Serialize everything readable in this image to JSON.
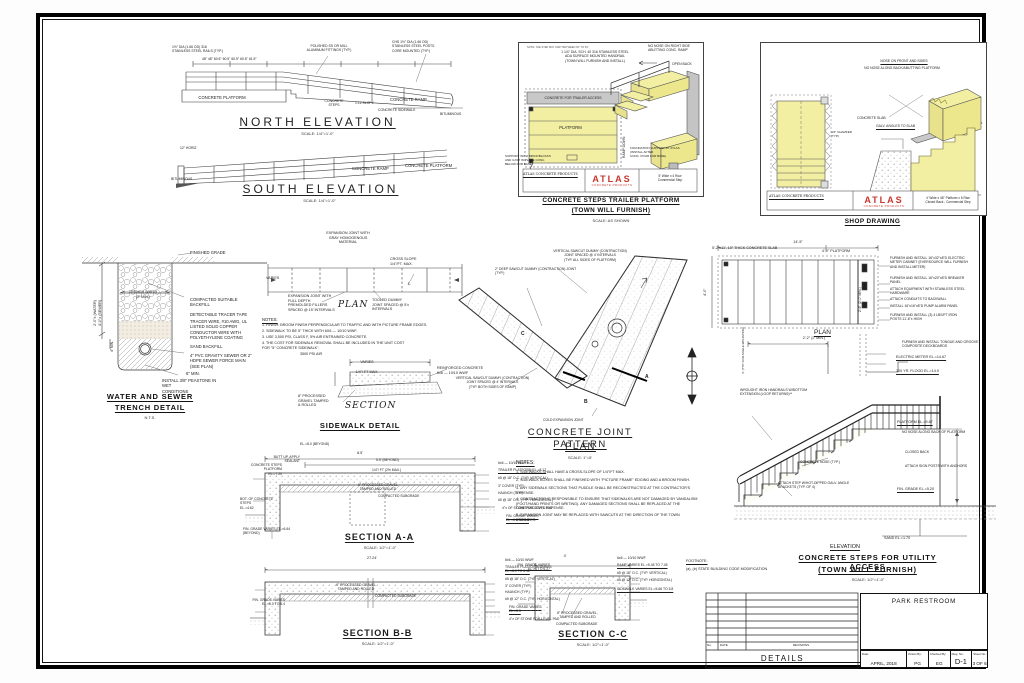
{
  "sheet": {
    "project": "PARK RESTROOM",
    "sheet_title": "DETAILS",
    "revisions_label": "REVISIONS",
    "no_label": "No.",
    "date_col_label": "DATE",
    "date_label": "Date:",
    "date": "APRIL, 2018",
    "drawn_label": "Drawn By:",
    "drawn": "PG",
    "checked_label": "Checked By:",
    "checked": "EG",
    "dwg_label": "Dwg. No.:",
    "dwg_no": "D-1",
    "sheet_no_label": "Sheet No.:",
    "sheet_no": "3 OF 6"
  },
  "north_elevation": {
    "title": "NORTH ELEVATION",
    "scale": "SCALE: 1/4\"=1'-0\"",
    "rail_note": "1½\" DIA (1.66 OD) 316\nSTAINLESS STEEL RAILS (TYP.)",
    "fittings_note": "POLISHED SS OR MILL\nALUMINUM FITTINGS (TYP.)",
    "posts_note": "CHS 1½\" DIA (1.66 OD)\nSTAINLESS STEEL POSTS\nCORE MOUNTED (TYP.)",
    "dims": "48\"        48\"        60.5\"        60.5\"        60.5\"        60.5\"        61.5\"",
    "platform": "CONCRETE PLATFORM",
    "steps": "CONCRETE\nSTEPS",
    "slope": "1:12 SLOPE",
    "ramp": "CONCRETE RAMP",
    "sidewalk": "CONCRETE SIDEWALK",
    "bituminous": "BITUMINOUS"
  },
  "south_elevation": {
    "title": "SOUTH ELEVATION",
    "scale": "SCALE: 1/4\"=1'-0\"",
    "horiz": "12\" HORIZ",
    "bituminous": "BITUMINOUS",
    "ramp": "CONCRETE RAMP",
    "platform": "CONCRETE PLATFORM"
  },
  "trailer_platform": {
    "small_note": "NOTE: THE STEP MAY VARY BETWEEN 52\" TO 54\"",
    "handrail_note": "1 1/4\" DIA. SCH. 40 316 STAINLESS STEEL\nADA SURFACE MOUNTED HANDRAIL\n(TOWN WILL FURNISH AND INSTALL)",
    "no_nose": "NO NOSE ON RIGHT SIDE\nABUTTING CONC. RAMP",
    "open_back": "OPEN BACK",
    "header": "CONCRETE FOR TRAILER ACCESS",
    "platform_label": "PLATFORM",
    "ramp_down": "RAMP DOWN",
    "support_note": "SUPPORT WITH BRICK/BLOCKS\nAND CAST IN PLACE CONC.\nBELOW FOR BASE",
    "foundation_note": "FOUNDATION SUPPORT BY ATLAS\n(INSTALL AFTER\nCONC. POUR FOR BASE)",
    "atlas_co": "ATLAS CONCRETE PRODUCTS",
    "atlas_logo": "ATLAS",
    "atlas_sub": "CONCRETE PRODUCTS",
    "product": "5' Wide x 4 Row\nCommercial Step",
    "title1": "CONCRETE STEPS TRAILER PLATFORM",
    "title2": "(TOWN WILL FURNISH)",
    "scale": "SCALE: AS SHOWN"
  },
  "shop_drawing": {
    "nose_note": "NOSE ON FRONT AND SIDES",
    "no_nose_note": "NO NOSE ALONG BACK/ABUTTING PLATFORM",
    "slab": "CONCRETE SLAB",
    "angles": "GALV. ANGLES TO SLAB",
    "chamfer": "3/4\" CHAMFER\n(TYP.)",
    "atlas_co": "ATLAS CONCRETE PRODUCTS",
    "atlas_logo": "ATLAS",
    "atlas_sub": "CONCRETE PRODUCTS",
    "product": "4' Wide x 48\" Platform x 6 Rise\nClosed Back - Commercial Step",
    "title": "SHOP DRAWING"
  },
  "trench_detail": {
    "finished_grade": "FINISHED GRADE",
    "trench_width": "TRENCH WIDTH\n(2' MIN.)",
    "backfill": "COMPACTED SUITABLE\nBACKFILL",
    "tracer_tape": "DETECTABLE TRACER TAPE",
    "tracer_wire": "TRACER WIRE, #10 AWG, UL\nLISTED SOLID COPPER\nCONDUCTOR WIRE WITH\nPOLYETHYLENE COATING",
    "sand": "SAND BACKFILL",
    "pipe": "4\" PVC GRAVITY SEWER OR 2\"\nHDPE SEWER FORCE MAIN\n(SEE PLAN)",
    "min6": "6\" MIN.",
    "peastone": "INSTALL 3/8\" PEASTONE IN WET\nCONDITIONS",
    "depth_dim": "2'-0\"± (WATER)\n4'-0\"± (SEWER)",
    "min4": "4\" MIN.",
    "title1": "WATER AND SEWER",
    "title2": "TRENCH DETAIL",
    "scale": "N.T.S."
  },
  "sidewalk_detail": {
    "plan_label": "PLAN",
    "varies": "VARIES",
    "exp_joint_top": "EXPANSION JOINT WITH\nGRAY HOMOGENOUS\nMATERIAL",
    "cross_slope": "CROSS SLOPE\n1/4\"/FT. MAX.",
    "exp_joint": "EXPANSION JOINT WITH\nFULL DEPTH\nPREMOLDED FILLERS\nSPACED @ 15' INTERVALS",
    "tooled": "TOOLED DUMMY\nJOINT SPACED @ 5'±\nINTERVALS",
    "notes_title": "NOTES:",
    "note1": "1. FINISH: BROOM FINISH PERPENDICULAR TO TRAFFIC AND WITH PICTURE FRAME EDGES.",
    "note2": "2. SIDEWALK TO BE 5\" THICK WITH 6X6 — 10/10 WWF.",
    "note3": "3. USE 3,500 PSI, CLASS F, 5% AIR ENTRAINED CONCRETE.",
    "note4": "4. THE COST FOR SIDEWALK REMOVAL SHALL BE INCLUDED IN THE UNIT COST\n    FOR \"5\" CONCRETE SIDEWALK\".",
    "psi": "3500 PSI AIR",
    "varies2": "VARIES",
    "slope2": "1/4\"/ FT MAX.",
    "reinf": "REINFORCED CONCRETE\n6x6 — 10/10 WWF",
    "gravel": "8\" PROCESSED\nGRAVEL TAMPED\n& ROLLED",
    "section_label": "SECTION",
    "title": "SIDEWALK DETAIL"
  },
  "joint_pattern": {
    "note1": "VERTICAL SAWCUT DUMMY (CONTRACTION)\nJOINT SPACED @ 4' INTERVALS\n(TYP. ALL SIDES OF PLATFORM)",
    "note2": "2\" DEEP SAWCUT DUMMY (CONTRACTION) JOINT\n(TYP.)",
    "note3": "VERTICAL SAWCUT DUMMY (CONTRACTION)\nJOINT SPACED @ 4' INTERVALS\n(TYP. BOTH SIDES OF RAMP)",
    "cold_joint": "COLD EXPANSION JOINT",
    "markers": {
      "a": "A",
      "b": "B",
      "c": "C"
    },
    "title1": "CONCRETE JOINT PATTERN",
    "title2": "PLAN",
    "scale": "SCALE: 1\"=5'"
  },
  "utility_plan": {
    "dim_overall": "14'-5\"",
    "slab_note": "5'-2\"x11', 10\" THICK CONCRETE SLAB",
    "platform_dim": "4'-0\" PLATFORM",
    "left_dim": "4'-0\"",
    "mid_dim": "2'-6\" (2'-0\" MIN.)",
    "callout1": "FURNISH AND INSTALL 16\"x32\"x8\"D ELECTRIC\nMETER CABINET (EVERSOURCE WILL FURNISH\nAND INSTALL METER)",
    "callout2": "FURNISH AND INSTALL 16\"x20\"x8\"D BREAKER\nPANEL",
    "callout3": "ATTACH EQUIPMENT WITH STAINLESS STEEL\nHARDWARE",
    "callout4": "ATTACH CONDUITS TO BACKWALL",
    "callout5": "INSTALL 16\"x16\"x8\"D PUMP ALARM PANEL",
    "callout6": "FURNISH AND INSTALL (3) 4 LBS/FT IRON\nPOSTS 11'-6\"± HIGH",
    "plan_label": "PLAN",
    "dim_bottom": "2'-2\" (2' MIN.)",
    "deck_note": "FURNISH AND INSTALL TONGUE AND GROOVE\nCOMPOSITE DECKBOARDS",
    "meter_el": "ELECTRIC METER EL.=14.67",
    "flood_el": "100 YR. FLOOD EL.=14.0",
    "angle_note": "4\" (TYP. FOR ANGLE MOUNTING)"
  },
  "utility_elevation": {
    "handrail": "WROUGHT IRON HANDRAILS W/BOTTOM\nEXTENSION (LOOP RETURNS)**",
    "platform_el": "PLATFORM EL.=9.67",
    "no_nose": "NO NOSE ALONG BACK OF PLATFORM",
    "closed_back": "CLOSED BACK",
    "sign_posts": "ATTACH SIGN POSTS WITH ANCHORS",
    "nose": "CONCRETE NOSE (TYP.)",
    "brackets": "ATTACH STEP W/HOT-DIPPED GALV. ANGLE\nBRACKETS (TYP. OF 4)",
    "fin_grade": "FIN. GRADE EL.=5.20",
    "sand_el": "SAND EL.=1.70",
    "elev_label": "ELEVATION",
    "title1": "CONCRETE STEPS FOR UTILITY ACCESS",
    "title2": "(TOWN WILL FURNISH)",
    "scale": "SCALE: 1/2\"=1'-0\""
  },
  "general_notes": {
    "title": "NOTES:",
    "item1": "1. SIDEWALKS SHALL HAVE A CROSS-SLOPE OF 1/4\"/FT MAX.",
    "item2": "2. SIDEWALK BOXES SHALL BE FINISHED WITH \"PICTURE FRAME\" EDGING AND A BROOM FINISH.",
    "item3": "3. ANY SIDEWALK SECTIONS THAT PUDDLE SHALL BE RECONSTRUCTED AT THE CONTRACTOR'S\n    EXPENSE.",
    "item4": "4. CONTRACTOR IS RESPONSIBLE TO ENSURE THAT SIDEWALKS ARE NOT DAMAGED BY VANDALISM\n    (FOOT/HAND PRINTS OR WRITING).  ANY DAMAGED SECTIONS SHALL BE REPLACED AT THE\n    CONTRACTOR'S EXPENSE.",
    "item5": "5. EXPANSION JOINT MAY BE REPLACED WITH SAWCUTS AT THE DIRECTION OF THE TOWN\n    ENGINEER."
  },
  "footnote": {
    "title": "FOOTNOTE:",
    "text": "(a), (b) STATE BUILDING CODE MODIFICATION"
  },
  "section_aa": {
    "el_beyond": "EL.=8.0 (BEYOND)",
    "dim1": "8.5'",
    "dim2": "5.5' (BEYOND)",
    "butt": "BUTT UP, APPLY\nSEALANT",
    "platform": "CONCRETE STEPS\nPLATFORM\nEL.=7.20",
    "slope": "1/4\"/ FT (2% MAX.)",
    "wwf": "6x6 — 10/10 WWF",
    "trailer_el": "TRAILER PLATFORM EL.=8.12",
    "vert": "#5 @ 18\" O.C. (TYP. VERTICAL)",
    "cover": "3\" COVER (TYP.)",
    "haunch": "HAUNCH (TYP.)",
    "horiz": "#5 @ 18\" O.C. (TYP. HORIZONTAL)",
    "stone": "4\"± OF STONE FOR LEVEL PAD",
    "fin_grade_r": "FIN. GRADE VARIES\nEL.=6.4 TO 5.3",
    "bot": "BOT. OF CONCRETE STEPS\nEL.=4.62",
    "gravel": "6\" PROCESSED GRAVEL\nTAMPED AND ROLLED",
    "subgrade": "COMPACTED SUBGRADE",
    "fin_grade_l": "FIN. GRADE VARIES EL.=6.64\n(BEYOND)",
    "title": "SECTION A-A",
    "scale": "SCALE: 1/2\"=1'-0\""
  },
  "section_bb": {
    "dim": "27.24'",
    "wwf": "6x6 — 10/10 WWF",
    "trailer": "TRAILER PLATFORM VARIES\nEL.=8.0 TO 8.12",
    "vert": "#5 @ 18\" O.C. (TYP. VERTICAL)",
    "cover": "3\" COVER (TYP.)",
    "haunch": "HAUNCH (TYP.)",
    "horiz": "#5 @ 12\" O.C. (TYP. HORIZONTAL)",
    "fin_grade_r": "FIN. GRADE VARIES\nEL.=5.5",
    "stone": "4\"± OF STONE FOR LEVEL PAD",
    "gravel": "6\" PROCESSED GRAVEL\nTAMPED AND ROLLED",
    "subgrade": "COMPACTED SUBGRADE",
    "fin_grade_l": "FIN. GRADE VARIES\nEL.=6.0 TO 5.4",
    "title": "SECTION B-B",
    "scale": "SCALE: 1/2\"=1'-0\""
  },
  "section_cc": {
    "dim": "4'",
    "wwf": "6x6 — 10/10 WWF",
    "ramp": "RAMP VARIES EL.=5.45 TO 7.45",
    "vert": "#5 @ 18\" O.C. (TYP. VERTICAL)",
    "horiz": "#5 @ 12\" O.C. (TYP. HORIZONTAL)",
    "sidewalk": "SIDEWALK VARIES EL.=5.66 TO 5.8",
    "fin_grade": "FIN. GRADE VARIES\nEL.=6 TO 6.27",
    "gravel": "8\" PROCESSED GRAVEL,\nTAMPED AND ROLLED",
    "subgrade": "COMPACTED SUBGRADE",
    "title": "SECTION C-C",
    "scale": "SCALE: 1/2\"=1'-0\""
  }
}
